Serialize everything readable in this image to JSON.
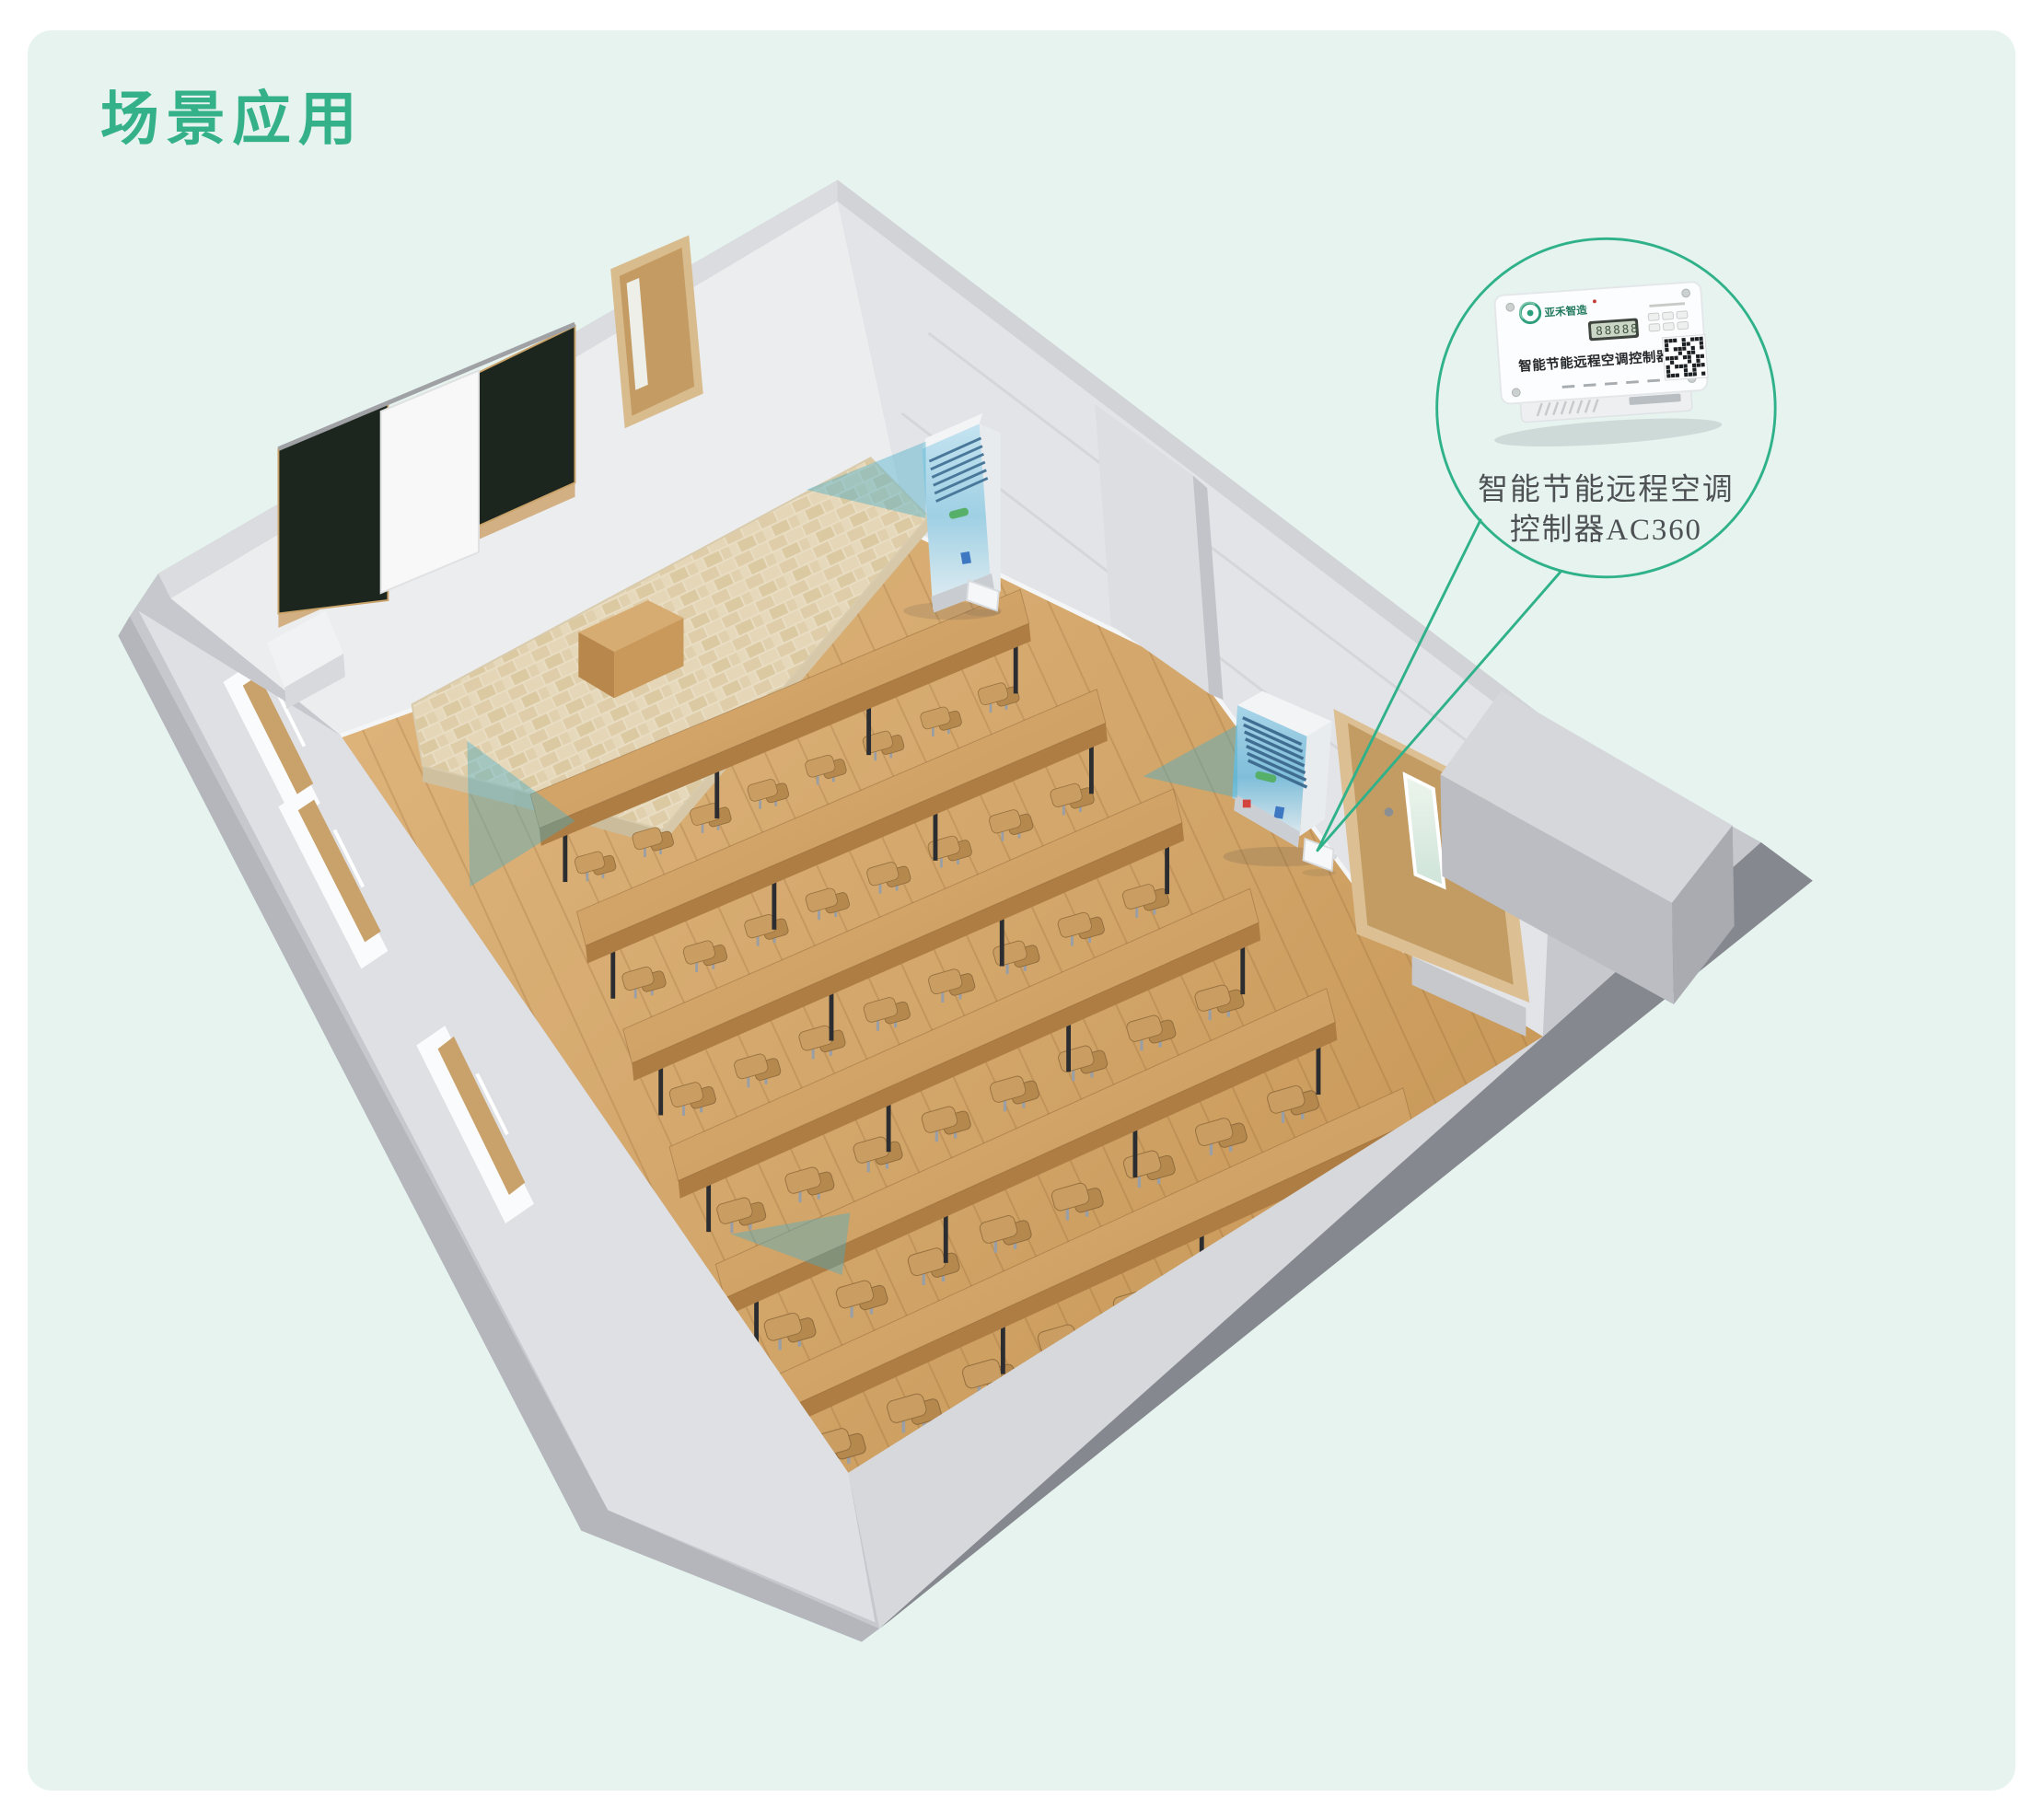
{
  "title": {
    "text": "场景应用"
  },
  "colors": {
    "page_bg": "#FFFFFF",
    "card_bg": "#E6F3EE",
    "accent_green": "#2FB189",
    "title_green": "#35B189",
    "airflow_teal": "#46AFCB",
    "wood_floor": "#CFA268",
    "wall_gray": "#C7C8CD",
    "blackboard_green": "#1C261E",
    "screen_white": "#F8F8F8",
    "ac_panel_blue": "#A8D4E6",
    "led_green": "#3E5340"
  },
  "callout": {
    "caption_line1": "智能节能远程空调",
    "caption_line2": "控制器AC360",
    "device": {
      "brand": "亚禾智造",
      "front_label": "智能节能远程空调控制器",
      "display_value": "88888"
    }
  },
  "scene": {
    "desk_rows": 6,
    "chairs_per_row": 8,
    "ac_units": 2,
    "ac_controllers": 2,
    "windows": 3,
    "doors": 2,
    "blackboard_panels": 2
  }
}
